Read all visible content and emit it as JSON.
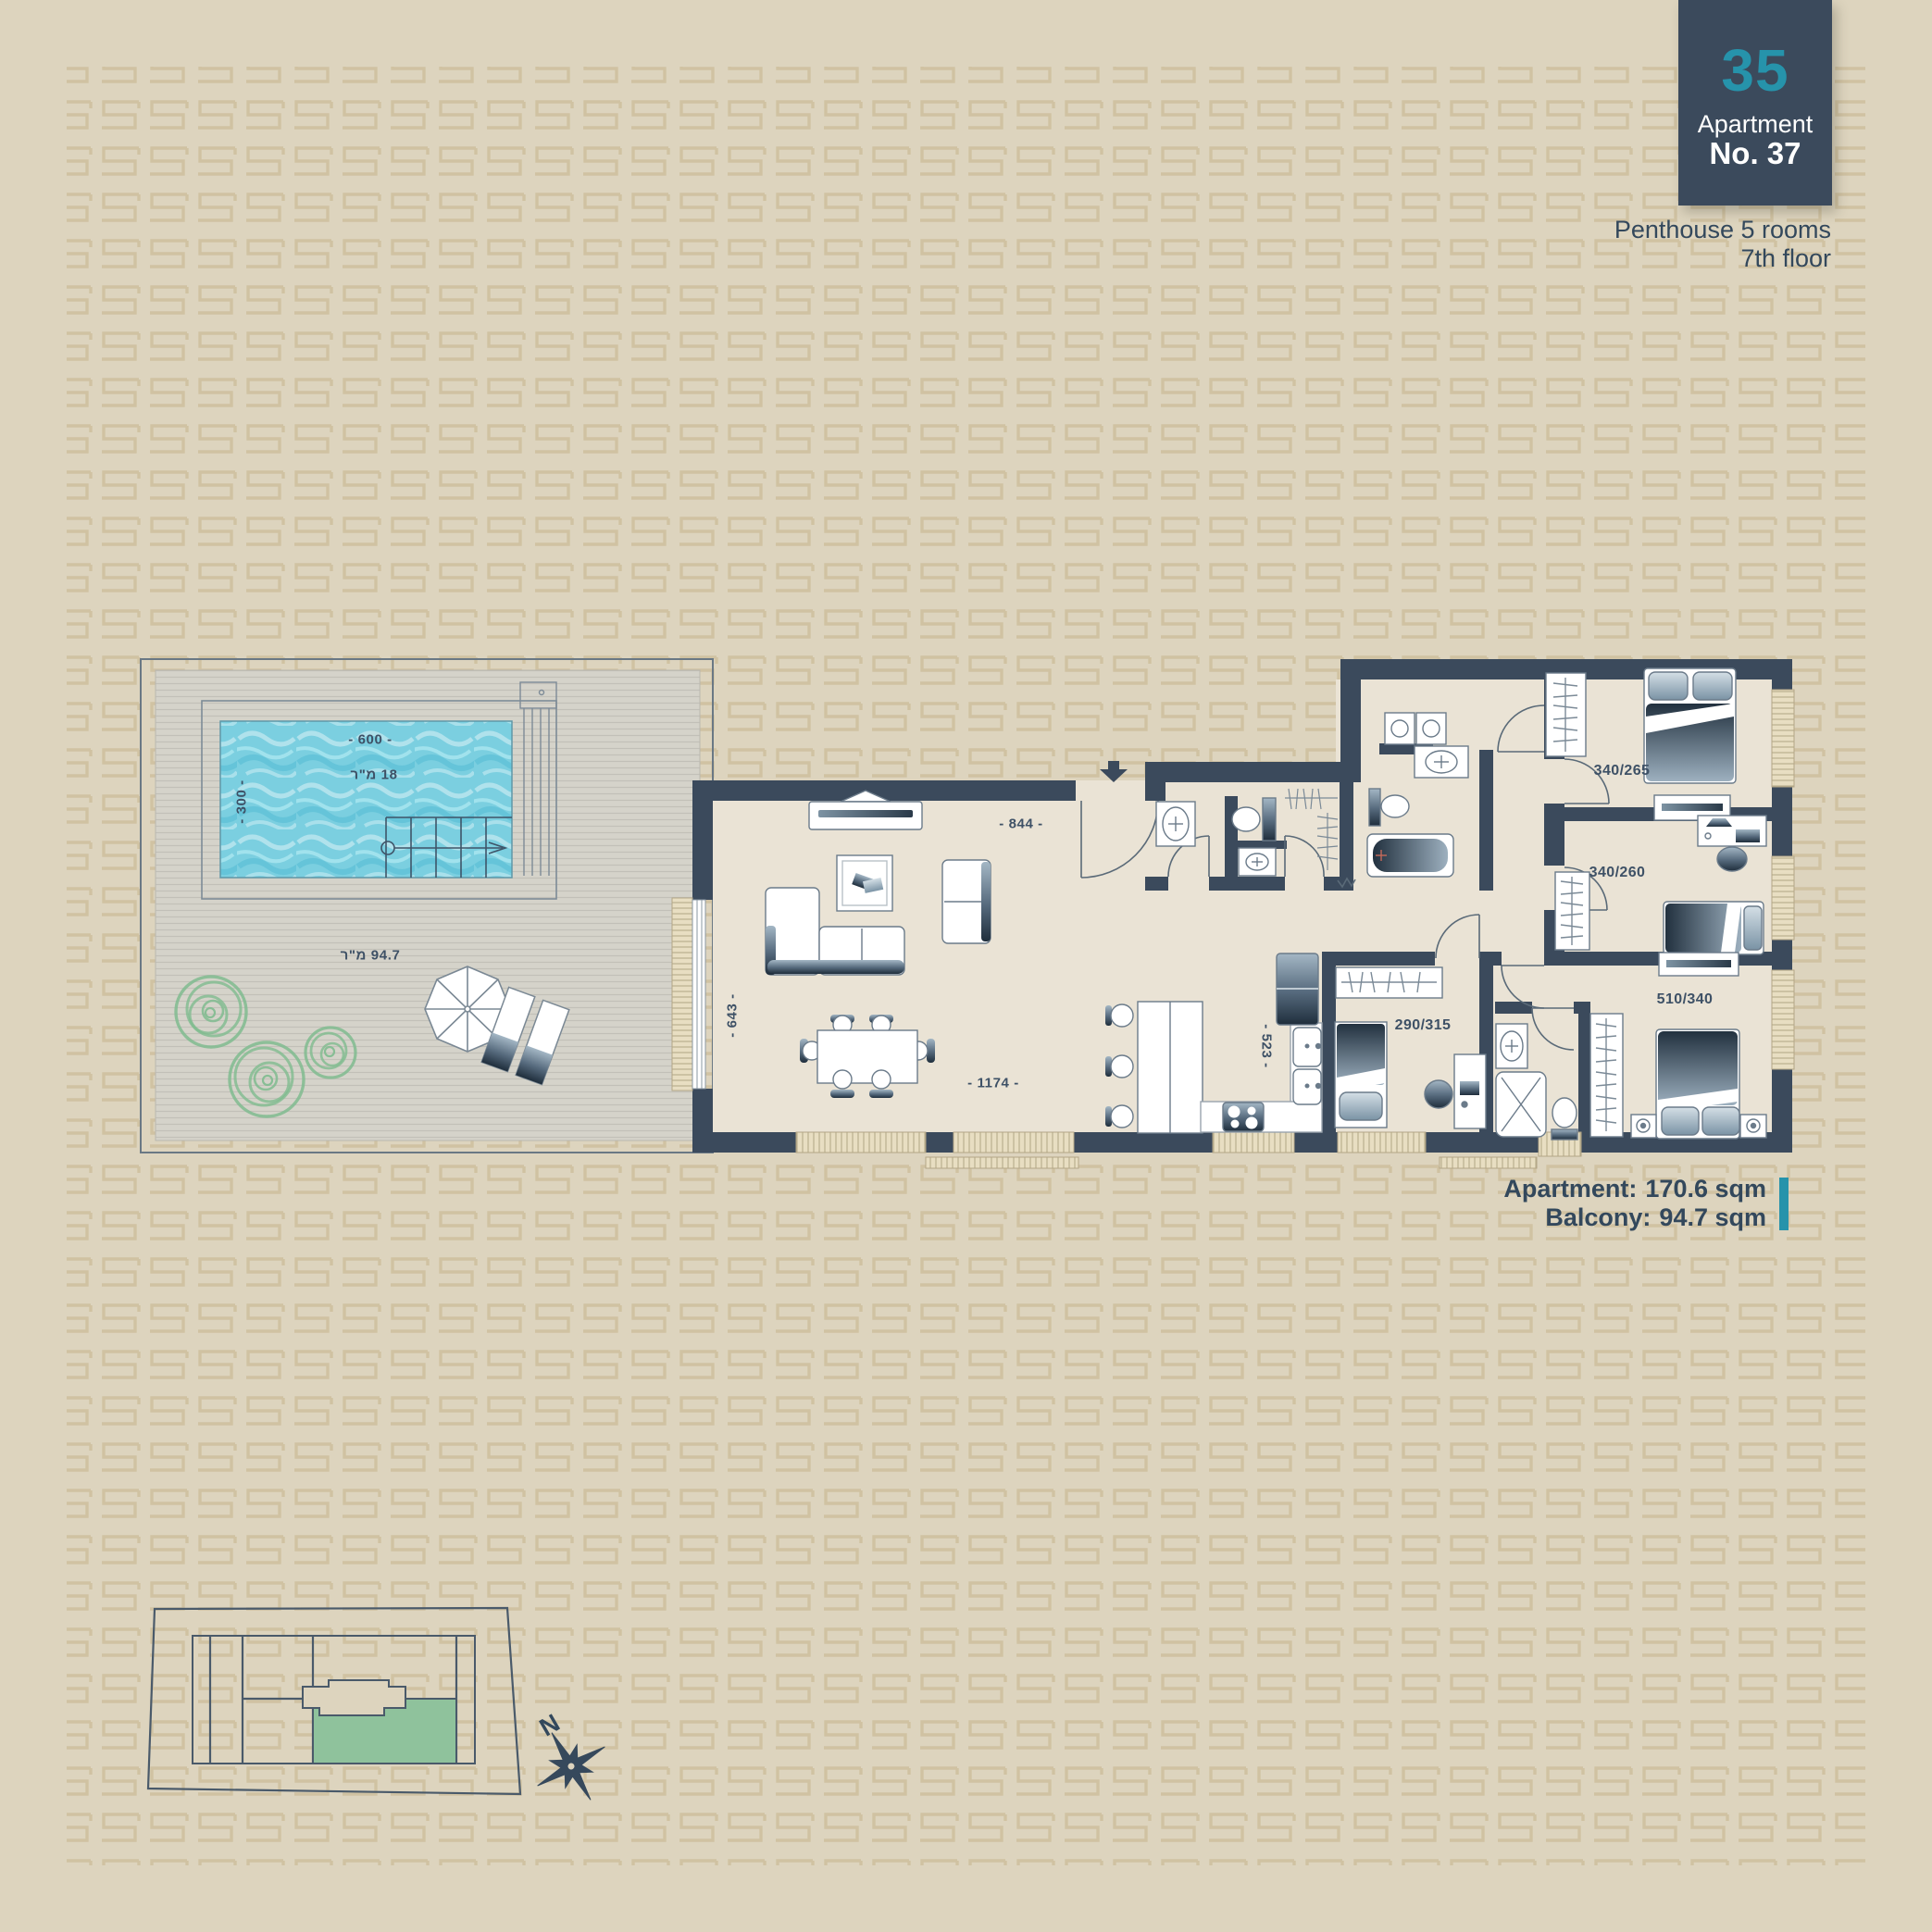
{
  "header": {
    "block_number": "35",
    "apartment_label": "Apartment",
    "apartment_no": "No. 37",
    "type_line": "Penthouse 5 rooms",
    "floor_line": "7th floor"
  },
  "areas": {
    "apartment_label": "Apartment:",
    "apartment_value": "170.6 sqm",
    "balcony_label": "Balcony:",
    "balcony_value": "94.7 sqm"
  },
  "balcony": {
    "width_dim": "- 600 -",
    "depth_dim": "- 300 -",
    "pool_area": "18 מ\"ר",
    "terrace_area": "94.7 מ\"ר"
  },
  "living": {
    "width_dim": "- 844 -",
    "height_dim": "- 643 -",
    "bottom_dim": "- 1174 -",
    "kitchen_dim": "- 523 -"
  },
  "bedrooms": {
    "middle": "290/315",
    "top_right": "340/265",
    "mid_right": "340/260",
    "master": "510/340"
  },
  "compass": {
    "north_label": "N"
  },
  "colors": {
    "background": "#ddd4be",
    "pattern": "#d0c2a2",
    "wall": "#3b4a5c",
    "floor": "#eae3d5",
    "deck": "#d5d3ca",
    "pool": "#7bcfe0",
    "navy": "#33485c",
    "teal": "#2693ab",
    "window": "#e8dec2",
    "plant": "#80bb8f",
    "site_green": "#8fc29c"
  }
}
